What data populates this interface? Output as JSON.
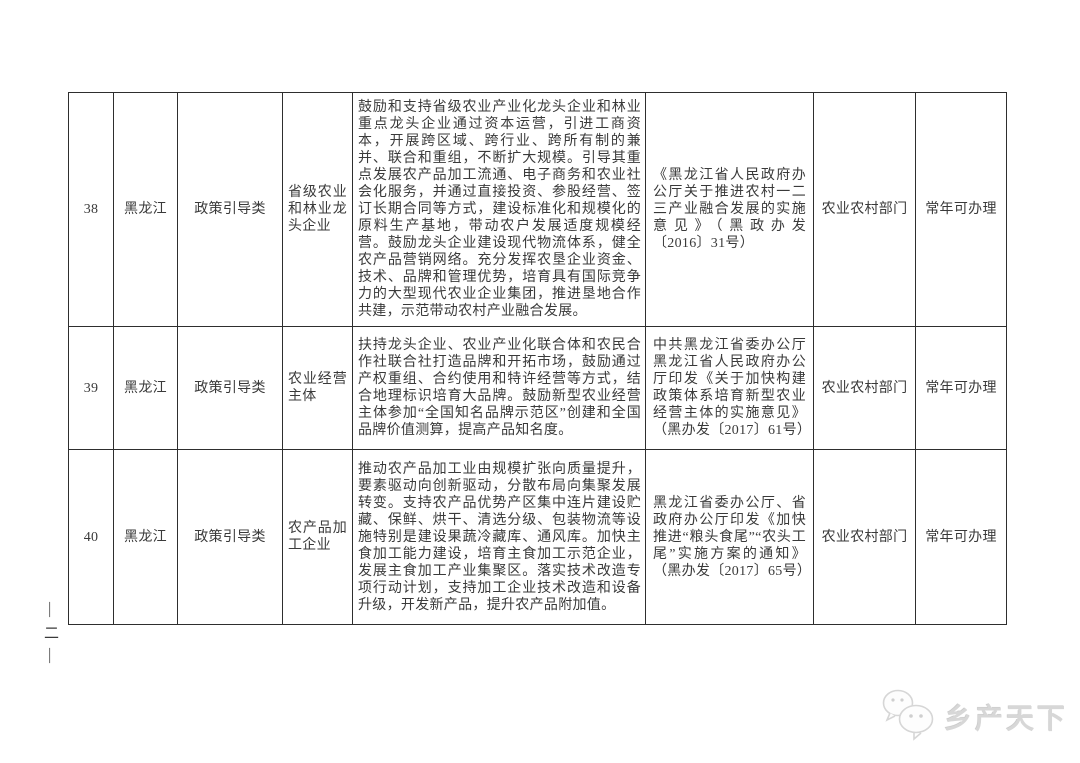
{
  "page": {
    "page_number": "—二—",
    "watermark_text": "乡产天下"
  },
  "table": {
    "rows": [
      {
        "no": "38",
        "province": "黑龙江",
        "category": "政策引导类",
        "target": "省级农业和林业龙头企业",
        "description": "鼓励和支持省级农业产业化龙头企业和林业重点龙头企业通过资本运营，引进工商资本，开展跨区域、跨行业、跨所有制的兼并、联合和重组，不断扩大规模。引导其重点发展农产品加工流通、电子商务和农业社会化服务，并通过直接投资、参股经营、签订长期合同等方式，建设标准化和规模化的原料生产基地，带动农户发展适度规模经营。鼓励龙头企业建设现代物流体系，健全农产品营销网络。充分发挥农垦企业资金、技术、品牌和管理优势，培育具有国际竞争力的大型现代农业企业集团，推进垦地合作共建，示范带动农村产业融合发展。",
        "document": "《黑龙江省人民政府办公厅关于推进农村一二三产业融合发展的实施意见》（黑政办发〔2016〕31号）",
        "department": "农业农村部门",
        "availability": "常年可办理"
      },
      {
        "no": "39",
        "province": "黑龙江",
        "category": "政策引导类",
        "target": "农业经营主体",
        "description": "扶持龙头企业、农业产业化联合体和农民合作社联合社打造品牌和开拓市场，鼓励通过产权重组、合约使用和特许经营等方式，结合地理标识培育大品牌。鼓励新型农业经营主体参加“全国知名品牌示范区”创建和全国品牌价值测算，提高产品知名度。",
        "document": "中共黑龙江省委办公厅黑龙江省人民政府办公厅印发《关于加快构建政策体系培育新型农业经营主体的实施意见》（黑办发〔2017〕61号）",
        "department": "农业农村部门",
        "availability": "常年可办理"
      },
      {
        "no": "40",
        "province": "黑龙江",
        "category": "政策引导类",
        "target": "农产品加工企业",
        "description": "推动农产品加工业由规模扩张向质量提升，要素驱动向创新驱动，分散布局向集聚发展转变。支持农产品优势产区集中连片建设贮藏、保鲜、烘干、清选分级、包装物流等设施特别是建设果蔬冷藏库、通风库。加快主食加工能力建设，培育主食加工示范企业，发展主食加工产业集聚区。落实技术改造专项行动计划，支持加工企业技术改造和设备升级，开发新产品，提升农产品附加值。",
        "document": "黑龙江省委办公厅、省政府办公厅印发《加快推进“粮头食尾”“农头工尾”实施方案的通知》（黑办发〔2017〕65号）",
        "department": "农业农村部门",
        "availability": "常年可办理"
      }
    ]
  }
}
